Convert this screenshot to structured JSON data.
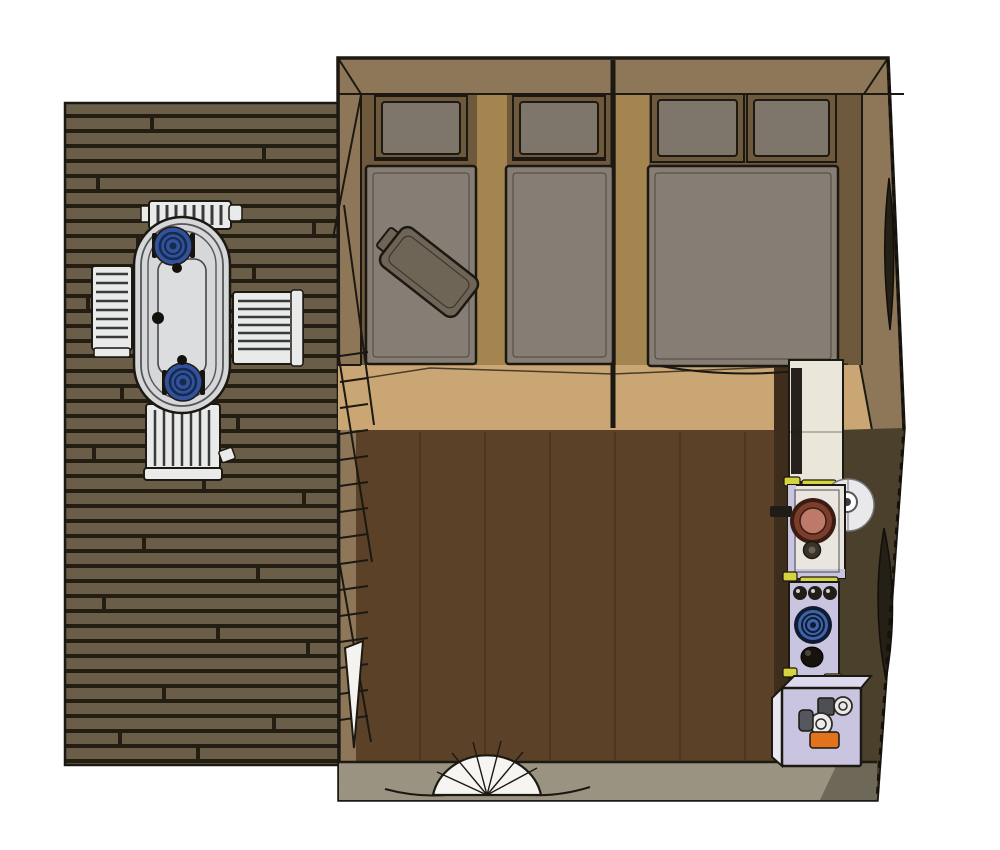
{
  "scene": {
    "title": "Top-view 3D render of a glamping tent cabin with side deck",
    "canvas": {
      "width": 1000,
      "height": 850
    },
    "deck": {
      "material": "dark wood planks",
      "furniture": {
        "table": {
          "shape": "oval",
          "plates_blue": 2
        },
        "chairs": 4
      }
    },
    "sleeping_area": {
      "single_beds": 2,
      "double_beds": 1,
      "pillows_total": 4,
      "loose_items": [
        "bag lying diagonally on left single bed"
      ],
      "partition_walls": 1
    },
    "living_area": {
      "floor": "dark walnut planks"
    },
    "kitchenette": {
      "fixtures": [
        "tall cabinet",
        "sink unit with round copper basin",
        "round wall fan",
        "stove with coil burner",
        "kettle",
        "storage box"
      ],
      "stove_knobs": 3,
      "box_items": [
        "grey canister",
        "two white jars",
        "orange box"
      ]
    },
    "openings": {
      "right_wall_lens_windows": 2,
      "front_entry": "folding fan door"
    }
  },
  "colors": {
    "outline": "#1c1812",
    "deck_plank": "#6a5e49",
    "deck_gap": "#241d12",
    "wall_tan": "#8d7758",
    "bedroom_floor": "#6e593c",
    "bed_gap_strip": "#a5854f",
    "mattress": "#867e74",
    "pillow": "#7e766b",
    "bag": "#6e6557",
    "tan_floor": "#c9a674",
    "walnut_floor": "#5b4128",
    "kitchen_wall": "#3f2d1b",
    "right_wall": "#4a402c",
    "bottom_band": "#9b9381",
    "corner_band": "#6e6858",
    "cabinet_cream": "#eae6da",
    "unit_white": "#e9e6df",
    "unit_lavender": "#c9c5e0",
    "yellow_trim": "#d6d43e",
    "sink_ring": "#7c3e2c",
    "sink_inner": "#bd7a6b",
    "burner_blue": "#3f63a8",
    "knob_black": "#221d17",
    "orange_item": "#e0731c",
    "table_grey": "#d6d7d8",
    "chair_white": "#e9eaea",
    "plate_blue": "#31519b",
    "window_dark": "#242015",
    "fan_white": "#f6f5f1",
    "white_disc": "#e9e9ec"
  }
}
